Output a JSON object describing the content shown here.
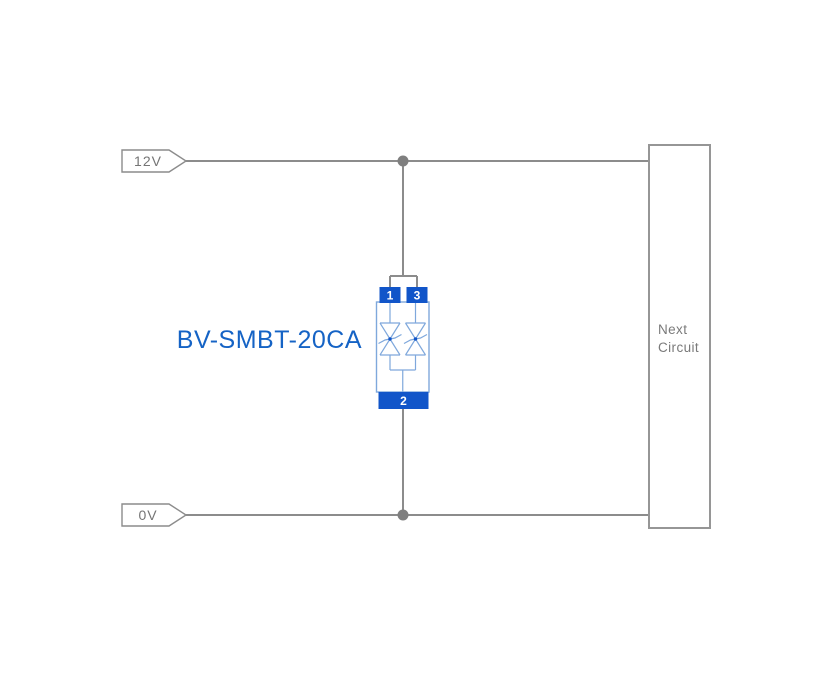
{
  "diagram": {
    "component_label": "BV-SMBT-20CA",
    "rails": {
      "power_label": "12V",
      "ground_label": "0V"
    },
    "component": {
      "pin1": "1",
      "pin2": "2",
      "pin3": "3",
      "type": "bidirectional-tvs-diode-array"
    },
    "next_circuit": {
      "line1": "Next",
      "line2": "Circuit"
    },
    "colors": {
      "wire_gray": "#8c8c8c",
      "junction_dot_gray": "#7f7f7f",
      "tag_text_gray": "#757575",
      "box_border_gray": "#969696",
      "box_text_gray": "#7a7a7a",
      "component_outline_blue": "#7fa8dc",
      "pad_fill_blue": "#1155c9",
      "title_blue": "#1563c5",
      "pin_number_white": "#ffffff",
      "background": "#ffffff"
    }
  }
}
